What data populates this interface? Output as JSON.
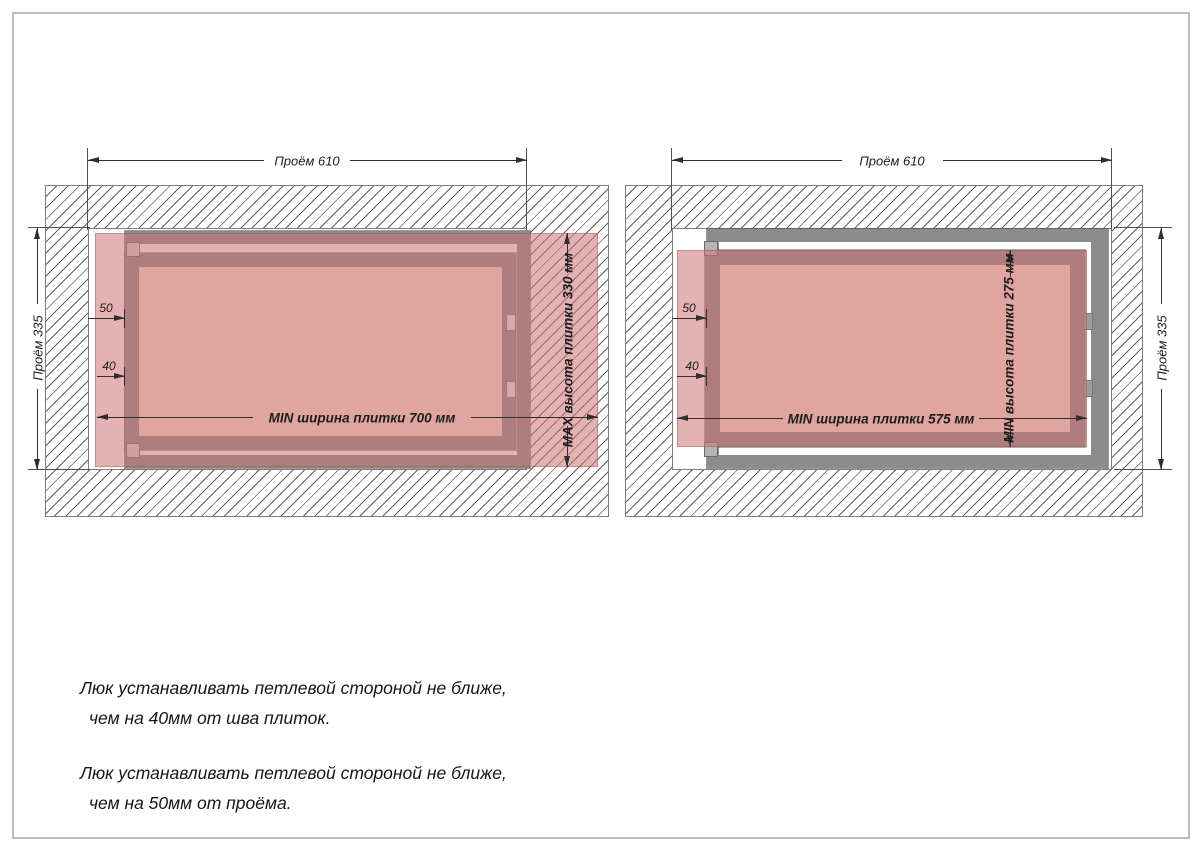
{
  "left_diagram": {
    "dim_top": "Проём 610",
    "dim_side": "Проём 335",
    "dim_hinge_opening": "50",
    "dim_hinge_seam": "40",
    "dim_tile_width": "MIN ширина плитки 700 мм",
    "dim_tile_height": "MAX высота плитки 330 мм"
  },
  "right_diagram": {
    "dim_top": "Проём 610",
    "dim_side": "Проём 335",
    "dim_hinge_opening": "50",
    "dim_hinge_seam": "40",
    "dim_tile_width": "MIN ширина плитки 575 мм",
    "dim_tile_height": "MIN высота плитки 275 мм"
  },
  "notes": {
    "note1_line1": "Люк устанавливать петлевой стороной не ближе,",
    "note1_line2": "чем на 40мм от шва плиток.",
    "note2_line1": "Люк устанавливать петлевой стороной не ближе,",
    "note2_line2": "чем на 50мм от проёма."
  },
  "colors": {
    "tile_overlay": "rgba(206,115,115,0.55)",
    "metal_gray": "#8b8b8b",
    "dimension_line": "#2f2f2f",
    "hatch_line": "#5f5f5f"
  }
}
